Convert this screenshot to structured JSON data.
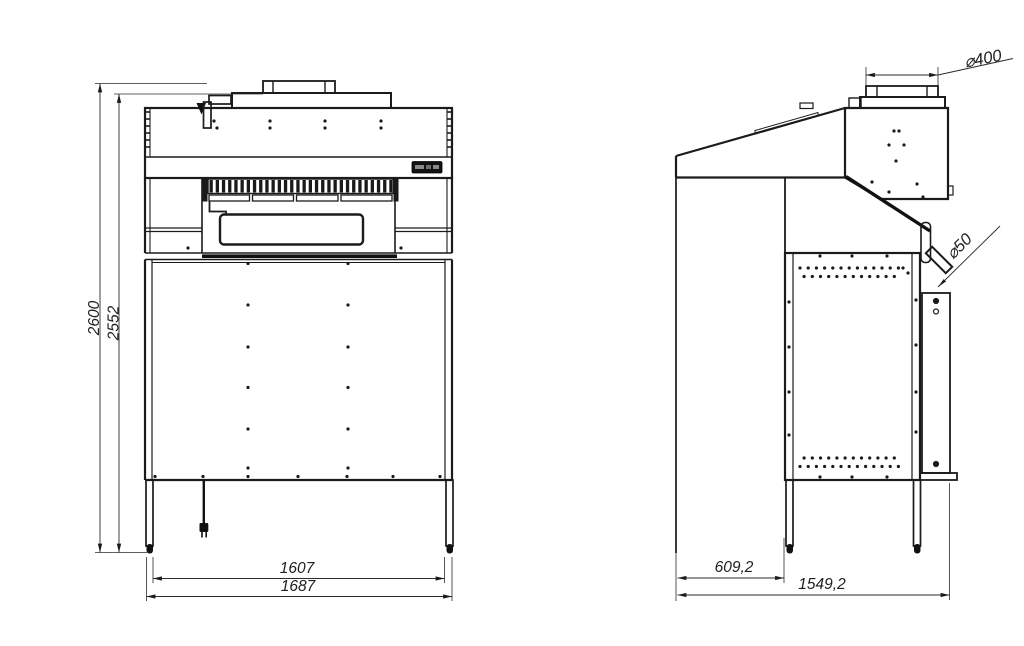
{
  "drawing": {
    "type": "technical-drawing-two-views",
    "views": {
      "front": {
        "dims": {
          "overall_height": "2600",
          "cabinet_height": "2552",
          "inner_leg_width": "1607",
          "overall_width": "1687"
        }
      },
      "side": {
        "dims": {
          "duct_diameter": "⌀400",
          "drain_diameter": "⌀50",
          "front_depth": "609,2",
          "overall_depth": "1549,2"
        }
      }
    },
    "icons": {
      "nameplate": "brand-nameplate",
      "power_plug": "power-plug"
    },
    "colors": {
      "background": "#ffffff",
      "line": "#1b1b1b",
      "dimension": "#2b2b2b",
      "nameplate": "#111111"
    }
  }
}
